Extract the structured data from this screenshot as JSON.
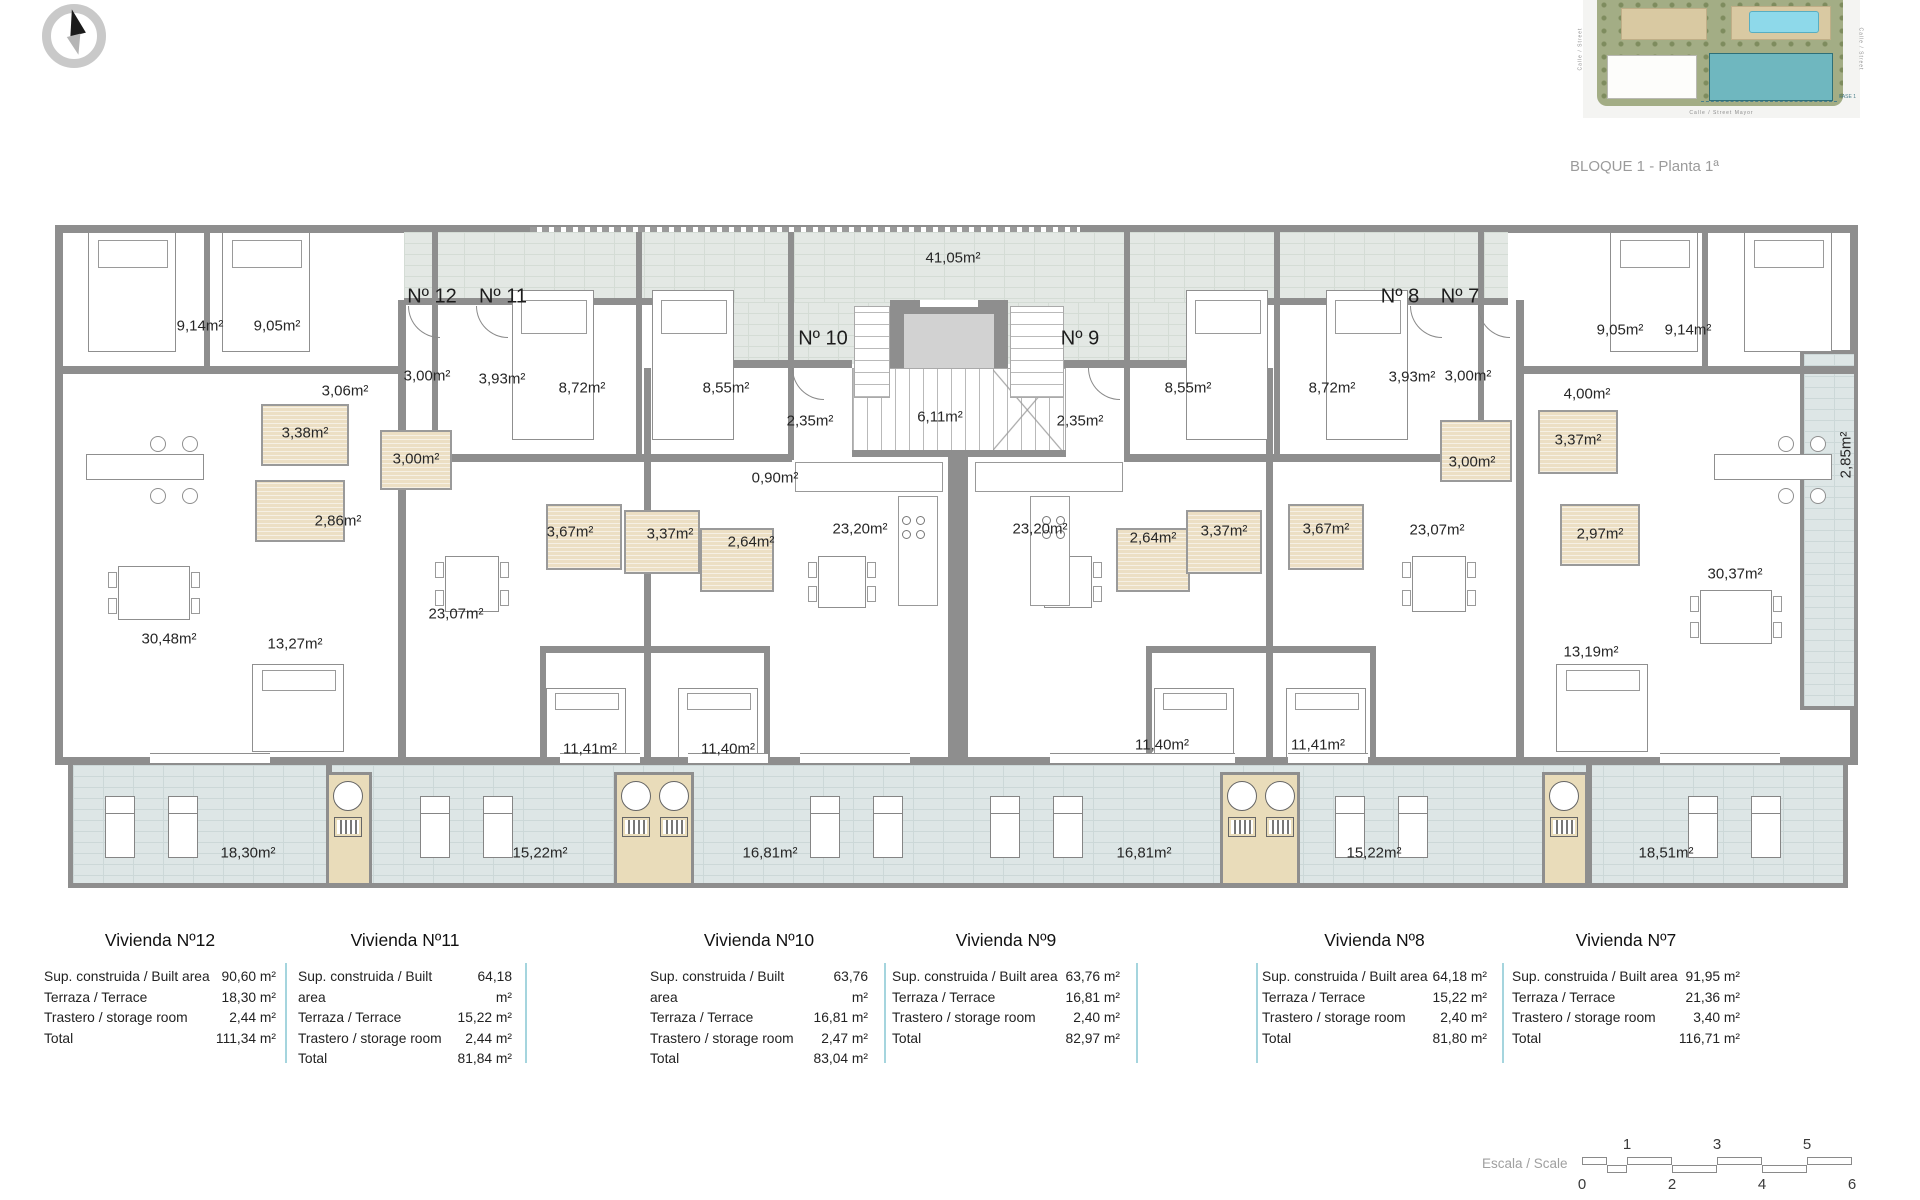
{
  "caption": "BLOQUE 1 - Planta 1ª",
  "site_plan": {
    "street_bottom": "Calle / Street Mayor",
    "street_left": "Calle / Street",
    "street_right": "Calle / Street",
    "fase_label": "FASE 1"
  },
  "plan": {
    "unit_labels": [
      {
        "text": "Nº 12",
        "x": 432,
        "y": 297
      },
      {
        "text": "Nº 11",
        "x": 503,
        "y": 297
      },
      {
        "text": "Nº 10",
        "x": 823,
        "y": 339
      },
      {
        "text": "Nº 9",
        "x": 1080,
        "y": 339
      },
      {
        "text": "Nº 8",
        "x": 1400,
        "y": 297
      },
      {
        "text": "Nº 7",
        "x": 1460,
        "y": 297
      }
    ],
    "room_labels": [
      {
        "text": "9,14m²",
        "x": 200,
        "y": 326
      },
      {
        "text": "9,05m²",
        "x": 277,
        "y": 326
      },
      {
        "text": "3,06m²",
        "x": 345,
        "y": 391
      },
      {
        "text": "3,00m²",
        "x": 427,
        "y": 376
      },
      {
        "text": "3,93m²",
        "x": 502,
        "y": 379
      },
      {
        "text": "8,72m²",
        "x": 582,
        "y": 388
      },
      {
        "text": "8,55m²",
        "x": 726,
        "y": 388
      },
      {
        "text": "41,05m²",
        "x": 953,
        "y": 258
      },
      {
        "text": "2,35m²",
        "x": 810,
        "y": 421
      },
      {
        "text": "6,11m²",
        "x": 940,
        "y": 417
      },
      {
        "text": "2,35m²",
        "x": 1080,
        "y": 421
      },
      {
        "text": "0,90m²",
        "x": 775,
        "y": 478
      },
      {
        "text": "3,38m²",
        "x": 305,
        "y": 433
      },
      {
        "text": "3,00m²",
        "x": 416,
        "y": 459
      },
      {
        "text": "2,86m²",
        "x": 338,
        "y": 521
      },
      {
        "text": "3,67m²",
        "x": 570,
        "y": 532
      },
      {
        "text": "3,37m²",
        "x": 670,
        "y": 534
      },
      {
        "text": "2,64m²",
        "x": 751,
        "y": 542
      },
      {
        "text": "23,20m²",
        "x": 860,
        "y": 529
      },
      {
        "text": "23,20m²",
        "x": 1040,
        "y": 529
      },
      {
        "text": "2,64m²",
        "x": 1153,
        "y": 538
      },
      {
        "text": "3,37m²",
        "x": 1224,
        "y": 531
      },
      {
        "text": "3,67m²",
        "x": 1326,
        "y": 529
      },
      {
        "text": "3,00m²",
        "x": 1472,
        "y": 462
      },
      {
        "text": "3,00m²",
        "x": 1468,
        "y": 376
      },
      {
        "text": "3,93m²",
        "x": 1412,
        "y": 377
      },
      {
        "text": "4,00m²",
        "x": 1587,
        "y": 394
      },
      {
        "text": "8,55m²",
        "x": 1188,
        "y": 388
      },
      {
        "text": "8,72m²",
        "x": 1332,
        "y": 388
      },
      {
        "text": "9,05m²",
        "x": 1620,
        "y": 330
      },
      {
        "text": "9,14m²",
        "x": 1688,
        "y": 330
      },
      {
        "text": "3,37m²",
        "x": 1578,
        "y": 440
      },
      {
        "text": "2,97m²",
        "x": 1600,
        "y": 534
      },
      {
        "text": "23,07m²",
        "x": 456,
        "y": 614
      },
      {
        "text": "23,07m²",
        "x": 1437,
        "y": 530
      },
      {
        "text": "30,48m²",
        "x": 169,
        "y": 639
      },
      {
        "text": "13,27m²",
        "x": 295,
        "y": 644
      },
      {
        "text": "13,19m²",
        "x": 1591,
        "y": 652
      },
      {
        "text": "30,37m²",
        "x": 1735,
        "y": 574
      },
      {
        "text": "11,41m²",
        "x": 590,
        "y": 749
      },
      {
        "text": "11,40m²",
        "x": 728,
        "y": 749
      },
      {
        "text": "11,40m²",
        "x": 1162,
        "y": 745
      },
      {
        "text": "11,41m²",
        "x": 1318,
        "y": 745
      },
      {
        "text": "18,30m²",
        "x": 248,
        "y": 853
      },
      {
        "text": "15,22m²",
        "x": 540,
        "y": 853
      },
      {
        "text": "16,81m²",
        "x": 770,
        "y": 853
      },
      {
        "text": "16,81m²",
        "x": 1144,
        "y": 853
      },
      {
        "text": "15,22m²",
        "x": 1374,
        "y": 853
      },
      {
        "text": "18,51m²",
        "x": 1666,
        "y": 853
      }
    ],
    "vertical_labels": [
      {
        "text": "2,85m²",
        "x": 1846,
        "y": 455
      }
    ]
  },
  "tables": [
    {
      "title": "Vivienda Nº12",
      "rows": [
        [
          "Sup. construida / Built area",
          "90,60 m²"
        ],
        [
          "Terraza / Terrace",
          "18,30 m²"
        ],
        [
          "Trastero / storage room",
          "2,44 m²"
        ],
        [
          "Total",
          "111,34 m²"
        ]
      ]
    },
    {
      "title": "Vivienda Nº11",
      "rows": [
        [
          "Sup. construida / Built area",
          "64,18 m²"
        ],
        [
          "Terraza / Terrace",
          "15,22 m²"
        ],
        [
          "Trastero / storage room",
          "2,44 m²"
        ],
        [
          "Total",
          "81,84 m²"
        ]
      ]
    },
    {
      "title": "Vivienda Nº10",
      "rows": [
        [
          "Sup. construida / Built area",
          "63,76 m²"
        ],
        [
          "Terraza / Terrace",
          "16,81 m²"
        ],
        [
          "Trastero / storage room",
          "2,47 m²"
        ],
        [
          "Total",
          "83,04 m²"
        ]
      ]
    },
    {
      "title": "Vivienda Nº9",
      "rows": [
        [
          "Sup. construida / Built area",
          "63,76 m²"
        ],
        [
          "Terraza / Terrace",
          "16,81 m²"
        ],
        [
          "Trastero / storage room",
          "2,40 m²"
        ],
        [
          "Total",
          "82,97 m²"
        ]
      ]
    },
    {
      "title": "Vivienda Nº8",
      "rows": [
        [
          "Sup. construida / Built area",
          "64,18 m²"
        ],
        [
          "Terraza / Terrace",
          "15,22 m²"
        ],
        [
          "Trastero / storage room",
          "2,40 m²"
        ],
        [
          "Total",
          "81,80 m²"
        ]
      ]
    },
    {
      "title": "Vivienda Nº7",
      "rows": [
        [
          "Sup. construida / Built area",
          "91,95 m²"
        ],
        [
          "Terraza / Terrace",
          "21,36 m²"
        ],
        [
          "Trastero / storage room",
          "3,40 m²"
        ],
        [
          "Total",
          "116,71 m²"
        ]
      ]
    }
  ],
  "scale": {
    "label": "Escala / Scale",
    "top_numbers": [
      "1",
      "3",
      "5"
    ],
    "bottom_numbers": [
      "0",
      "2",
      "4",
      "6"
    ]
  },
  "colors": {
    "wall": "#8e8e8e",
    "corridor": "#e3e8e4",
    "terrace": "#dde6e6",
    "bathroom": "#ecdfc4",
    "storage": "#e9dcba",
    "table_divider": "#a5d5de",
    "highlight_building": "#6fb7bf"
  }
}
